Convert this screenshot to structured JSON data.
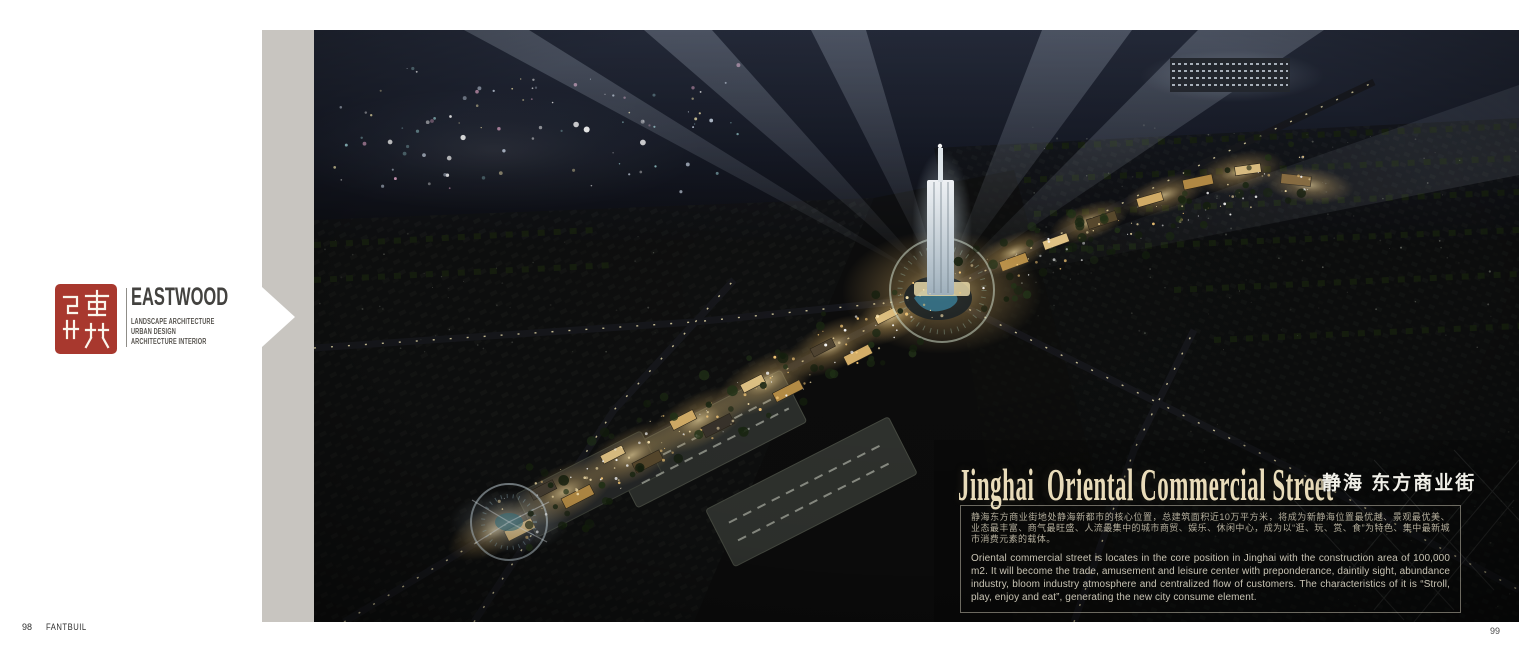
{
  "brand": {
    "name": "EASTWOOD",
    "disciplines": [
      "LANDSCAPE ARCHITECTURE",
      "URBAN DESIGN",
      "ARCHITECTURE INTERIOR"
    ]
  },
  "project": {
    "title_en": "Jinghai  Oriental Commercial Street",
    "title_zh": "静海 东方商业街",
    "description_zh": "静海东方商业街地处静海新都市的核心位置，总建筑面积近10万平方米，将成为新静海位置最优越、景观最优美、业态最丰富、商气最旺盛、人流最集中的城市商贸、娱乐、休闲中心，成为以“逛、玩、赏、食”为特色、集中最新城市消费元素的载体。",
    "description_en": "Oriental commercial street is locates in the core position in Jinghai with the construction area of 100,000 m2. It will become the trade, amusement and leisure center with preponderance, daintily sight, abundance industry, bloom industry atmosphere and centralized flow of customers. The characteristics of it is “Stroll, play, enjoy and eat”, generating the new city consume element."
  },
  "footer": {
    "left_page_number": "98",
    "left_mark": "FANTBUIL",
    "right_page_number": "99"
  },
  "colors": {
    "seal_red": "#a8382e",
    "spine_gray": "#c8c5c0",
    "title_cream": "#e9dcba"
  }
}
